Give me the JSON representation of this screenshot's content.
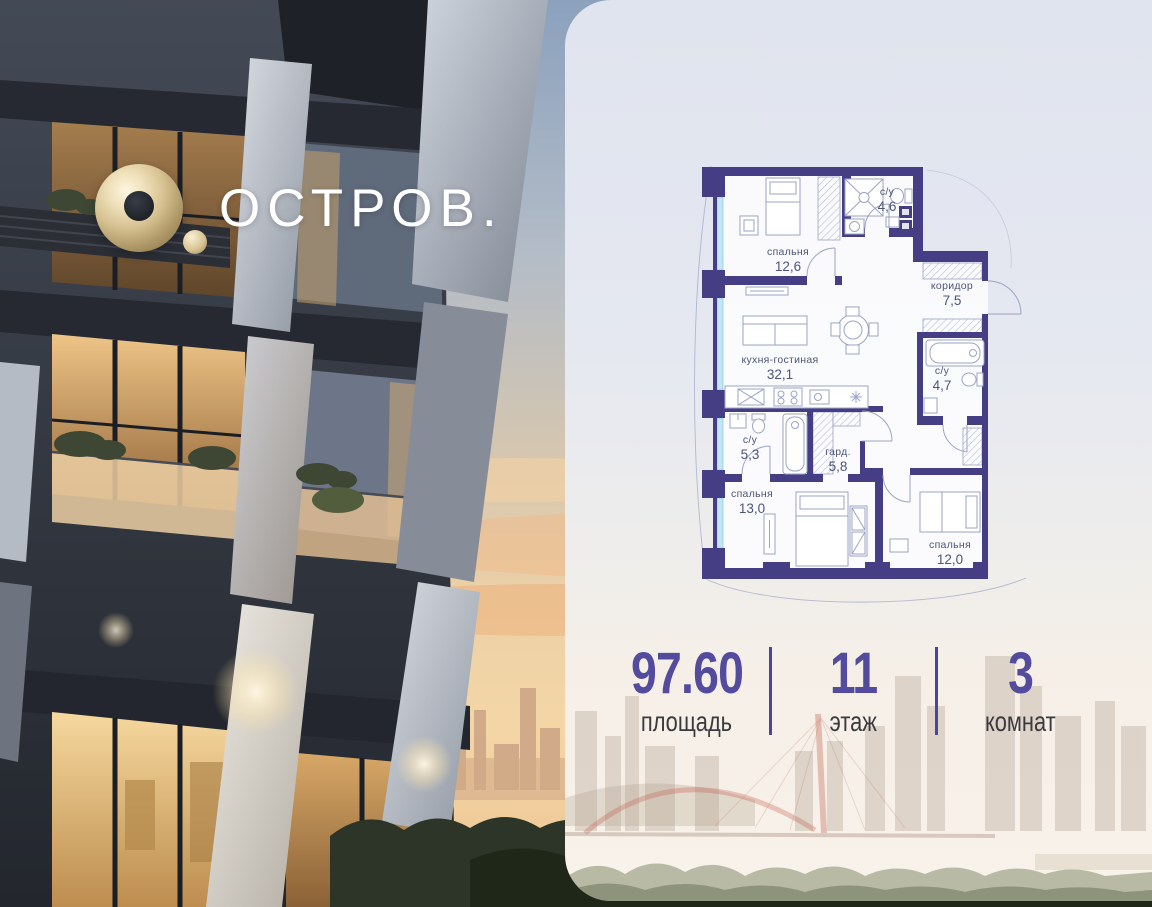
{
  "brand": {
    "logo_text": "ОСТРОВ."
  },
  "floor_plan": {
    "rooms": [
      {
        "name": "спальня",
        "area": "12,6"
      },
      {
        "name": "с/у",
        "area": "4,6"
      },
      {
        "name": "коридор",
        "area": "7,5"
      },
      {
        "name": "кухня-гостиная",
        "area": "32,1"
      },
      {
        "name": "с/у",
        "area": "4,7"
      },
      {
        "name": "с/у",
        "area": "5,3"
      },
      {
        "name": "гард.",
        "area": "5,8"
      },
      {
        "name": "спальня",
        "area": "13,0"
      },
      {
        "name": "спальня",
        "area": "12,0"
      }
    ]
  },
  "stats": {
    "items": [
      {
        "value": "97.60",
        "label": "площадь"
      },
      {
        "value": "11",
        "label": "этаж"
      },
      {
        "value": "3",
        "label": "комнат"
      }
    ]
  },
  "colors": {
    "wall": "#453e85",
    "accent": "#534b9e",
    "window_glass": "#c3e6f5",
    "furniture_line": "#9aa4c4",
    "label_text": "#4d5578"
  }
}
